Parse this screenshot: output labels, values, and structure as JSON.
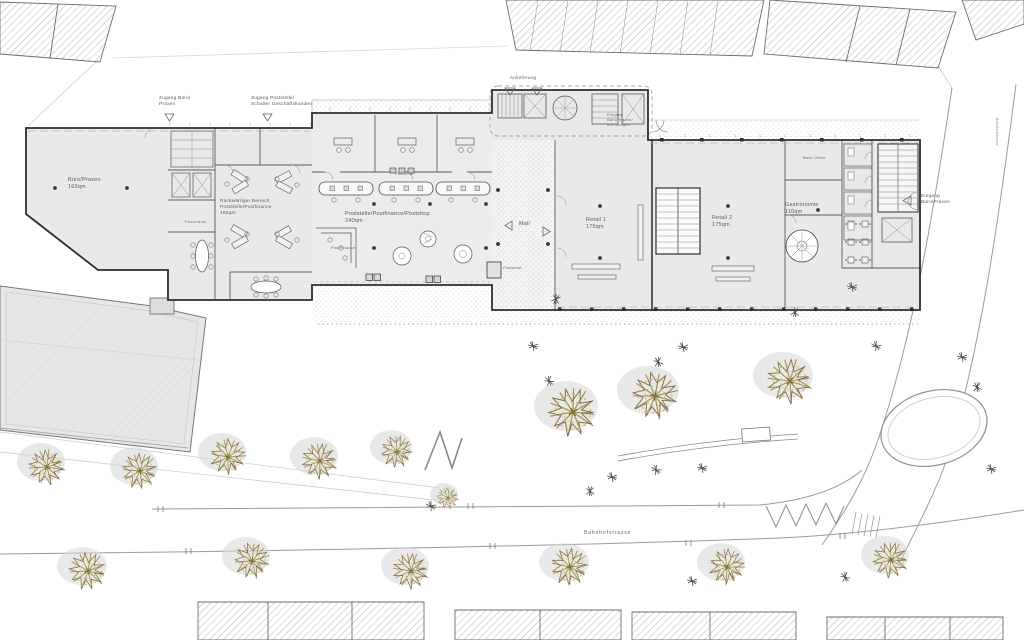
{
  "labels": {
    "anlieferung": "Anlieferung",
    "zugang_buero_praxen": "Zugang Büro/\nPraxen",
    "zugang_poststelle": "Zugang Poststelle/\nSchalter Geschäftskunden",
    "eingang_wohnungen": "Eingang\nBüro/Praxen/\nWohnungen",
    "eingang_buero_praxen": "Eingang\nBüro/Praxen",
    "buero_praxen": "Büro/Praxen\n163qm",
    "rueckwaertiger_bereich": "Rückwärtiger Bereich\nPoststelle/Postfinance\n160qm",
    "tresorraum": "Tresorraum",
    "postomat_halle": "Postomat",
    "poststelle": "Poststelle/Postfinance/Postshop\n240qm",
    "postfinance": "PostFinance",
    "mall": "Mall",
    "postomat_mall": "Postomat",
    "retail_1": "Retail 1\n175qm",
    "retail_2": "Retail 2\n175qm",
    "gastronomie": "Gastronomie\n110qm",
    "back_office": "Back Office",
    "bahnhofstrasse": "Bahnhofstrasse",
    "side_street": "Bahnhofstrasse"
  },
  "areas_qm": {
    "buero_praxen": 163,
    "rueckwaertiger_bereich": 160,
    "poststelle": 240,
    "retail_1": 175,
    "retail_2": 175,
    "gastronomie": 110
  },
  "colors": {
    "background": "#ffffff",
    "building_fill": "#e9e9e9",
    "hall_fill": "#ececec",
    "wall": "#2e2e2e",
    "partition": "#5a5a5a",
    "line_light": "#a8a8a8",
    "hatch": "#8a8a8a",
    "tree_light": "#c3b274",
    "tree_mid": "#a6924f",
    "tree_dark": "#7d6c38",
    "shrub": "#52503c",
    "shadow": "#d7d7d7",
    "text": "#5a5a5a",
    "street_line": "#9b9b9b"
  }
}
